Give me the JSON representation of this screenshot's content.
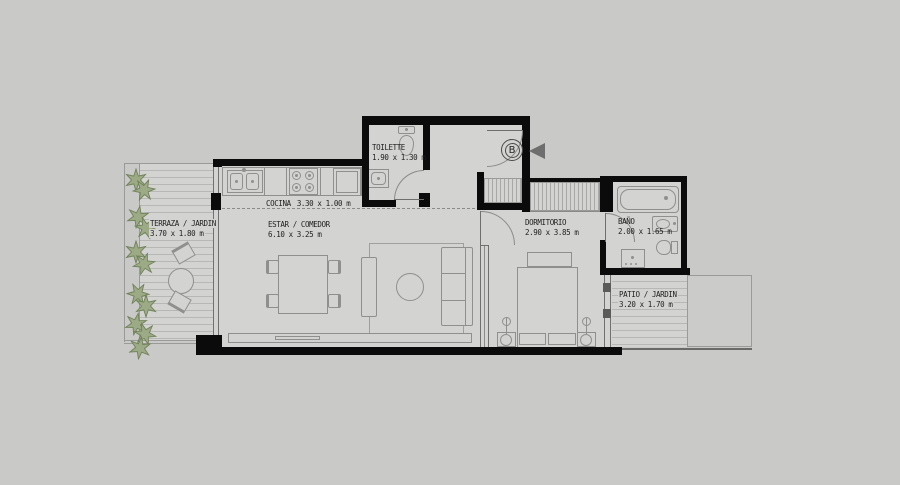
{
  "colors": {
    "background": "#c9c9c7",
    "floor": "#d3d3d1",
    "wall": "#0b0b0b",
    "furniture_line": "#8f8f8d",
    "deck_line": "#b7b7b5",
    "text": "#1f1f1f",
    "plant": "#9cab85",
    "arrow": "#6e6e6e"
  },
  "entrance": {
    "marker": "B"
  },
  "rooms": {
    "terraza": {
      "label": "TERRAZA / JARDIN",
      "dims": "3.70 x 1.80 m"
    },
    "cocina": {
      "label": "COCINA",
      "dims": "3.30 x 1.00 m"
    },
    "estar": {
      "label": "ESTAR / COMEDOR",
      "dims": "6.10 x 3.25 m"
    },
    "toilette": {
      "label": "TOILETTE",
      "dims": "1.90 x 1.30 m"
    },
    "dormitorio": {
      "label": "DORMITORIO",
      "dims": "2.90 x 3.85 m"
    },
    "bano": {
      "label": "BAÑO",
      "dims": "2.00 x 1.65 m"
    },
    "patio": {
      "label": "PATIO / JARDIN",
      "dims": "3.20 x 1.70 m"
    }
  }
}
